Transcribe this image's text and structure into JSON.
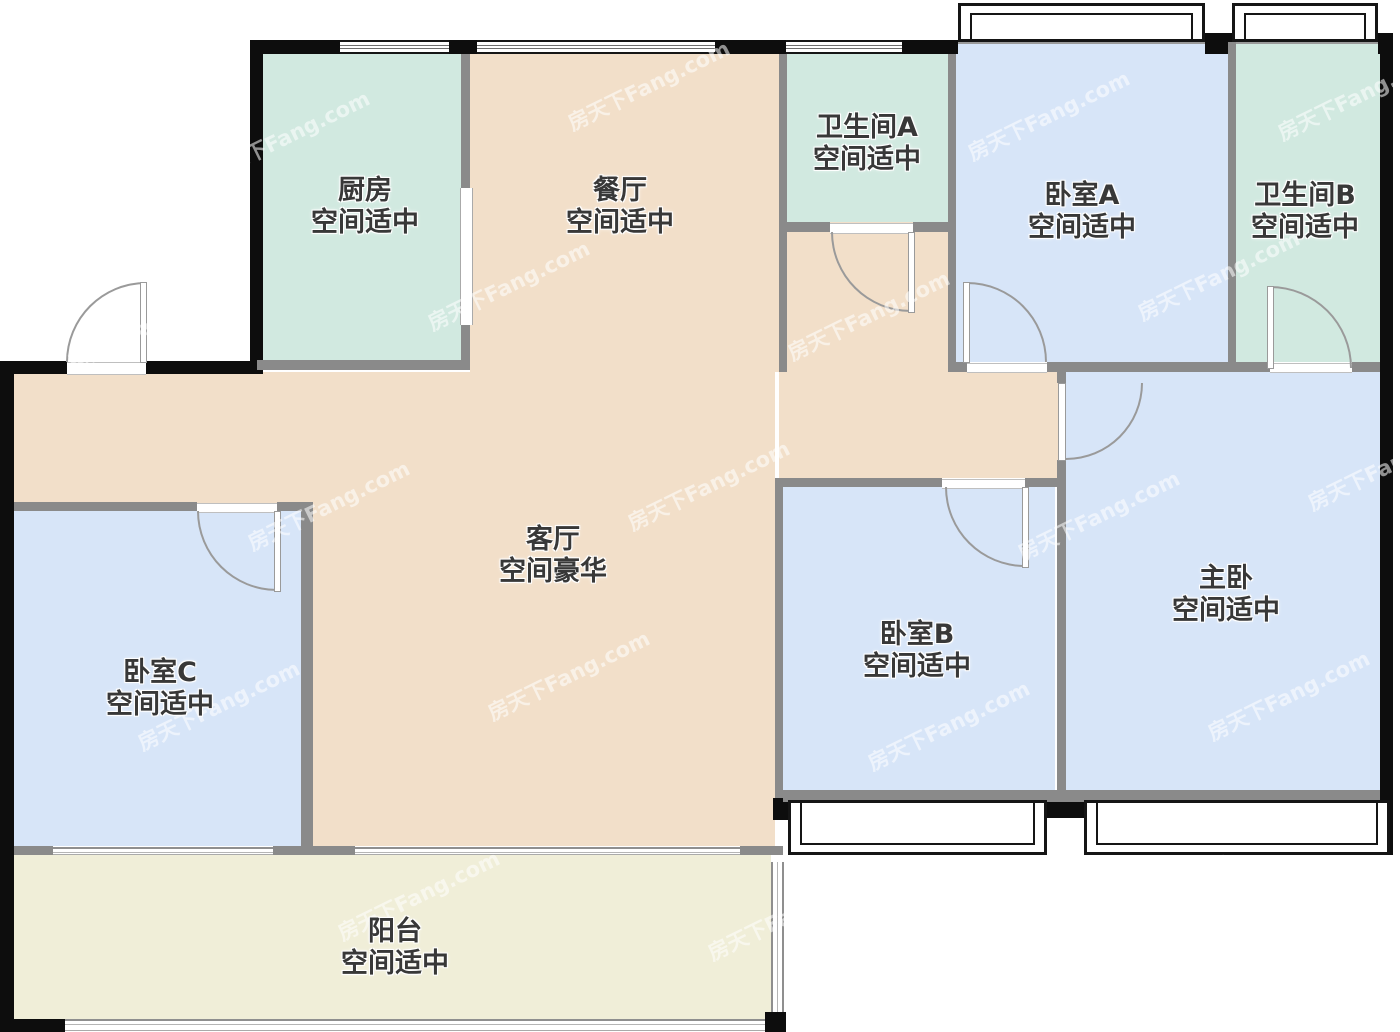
{
  "watermark": {
    "text": "房天下Fang.com"
  },
  "colors": {
    "kitchen_bath": "#d1e9e0",
    "dining_living": "#f2dfc9",
    "bedroom": "#d7e5f8",
    "balcony": "#f0eed8",
    "wall_exterior": "#0d0d0d",
    "wall_interior": "#8a8a8a",
    "door_arc": "#9a9a9a",
    "label_text": "#383838"
  },
  "rooms": [
    {
      "id": "kitchen",
      "name": "厨房",
      "quality": "空间适中"
    },
    {
      "id": "dining",
      "name": "餐厅",
      "quality": "空间适中"
    },
    {
      "id": "bathroom-a",
      "name": "卫生间A",
      "quality": "空间适中"
    },
    {
      "id": "bedroom-a",
      "name": "卧室A",
      "quality": "空间适中"
    },
    {
      "id": "bathroom-b",
      "name": "卫生间B",
      "quality": "空间适中"
    },
    {
      "id": "living",
      "name": "客厅",
      "quality": "空间豪华"
    },
    {
      "id": "bedroom-c",
      "name": "卧室C",
      "quality": "空间适中"
    },
    {
      "id": "bedroom-b",
      "name": "卧室B",
      "quality": "空间适中"
    },
    {
      "id": "master",
      "name": "主卧",
      "quality": "空间适中"
    },
    {
      "id": "balcony",
      "name": "阳台",
      "quality": "空间适中"
    }
  ]
}
